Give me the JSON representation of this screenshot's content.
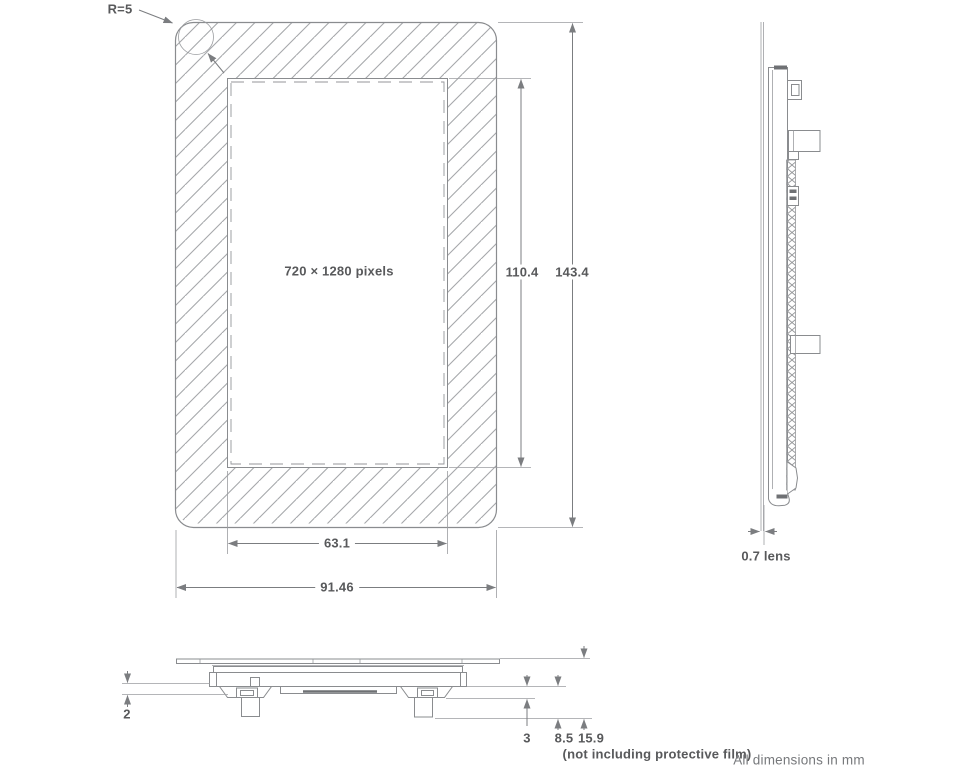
{
  "front_view": {
    "corner_radius_label": "R=5",
    "resolution_label": "720 × 1280 pixels",
    "active_area_height": "110.4",
    "outline_height": "143.4",
    "active_area_width": "63.1",
    "outline_width": "91.46"
  },
  "side_view": {
    "lens_thickness_label": "0.7 lens"
  },
  "bottom_view": {
    "flange_gap": "2",
    "connector_step": "3",
    "module_thickness": "8.5",
    "total_thickness": "15.9",
    "film_note": "(not including protective film)"
  },
  "footer": {
    "units_note": "All dimensions in mm"
  }
}
